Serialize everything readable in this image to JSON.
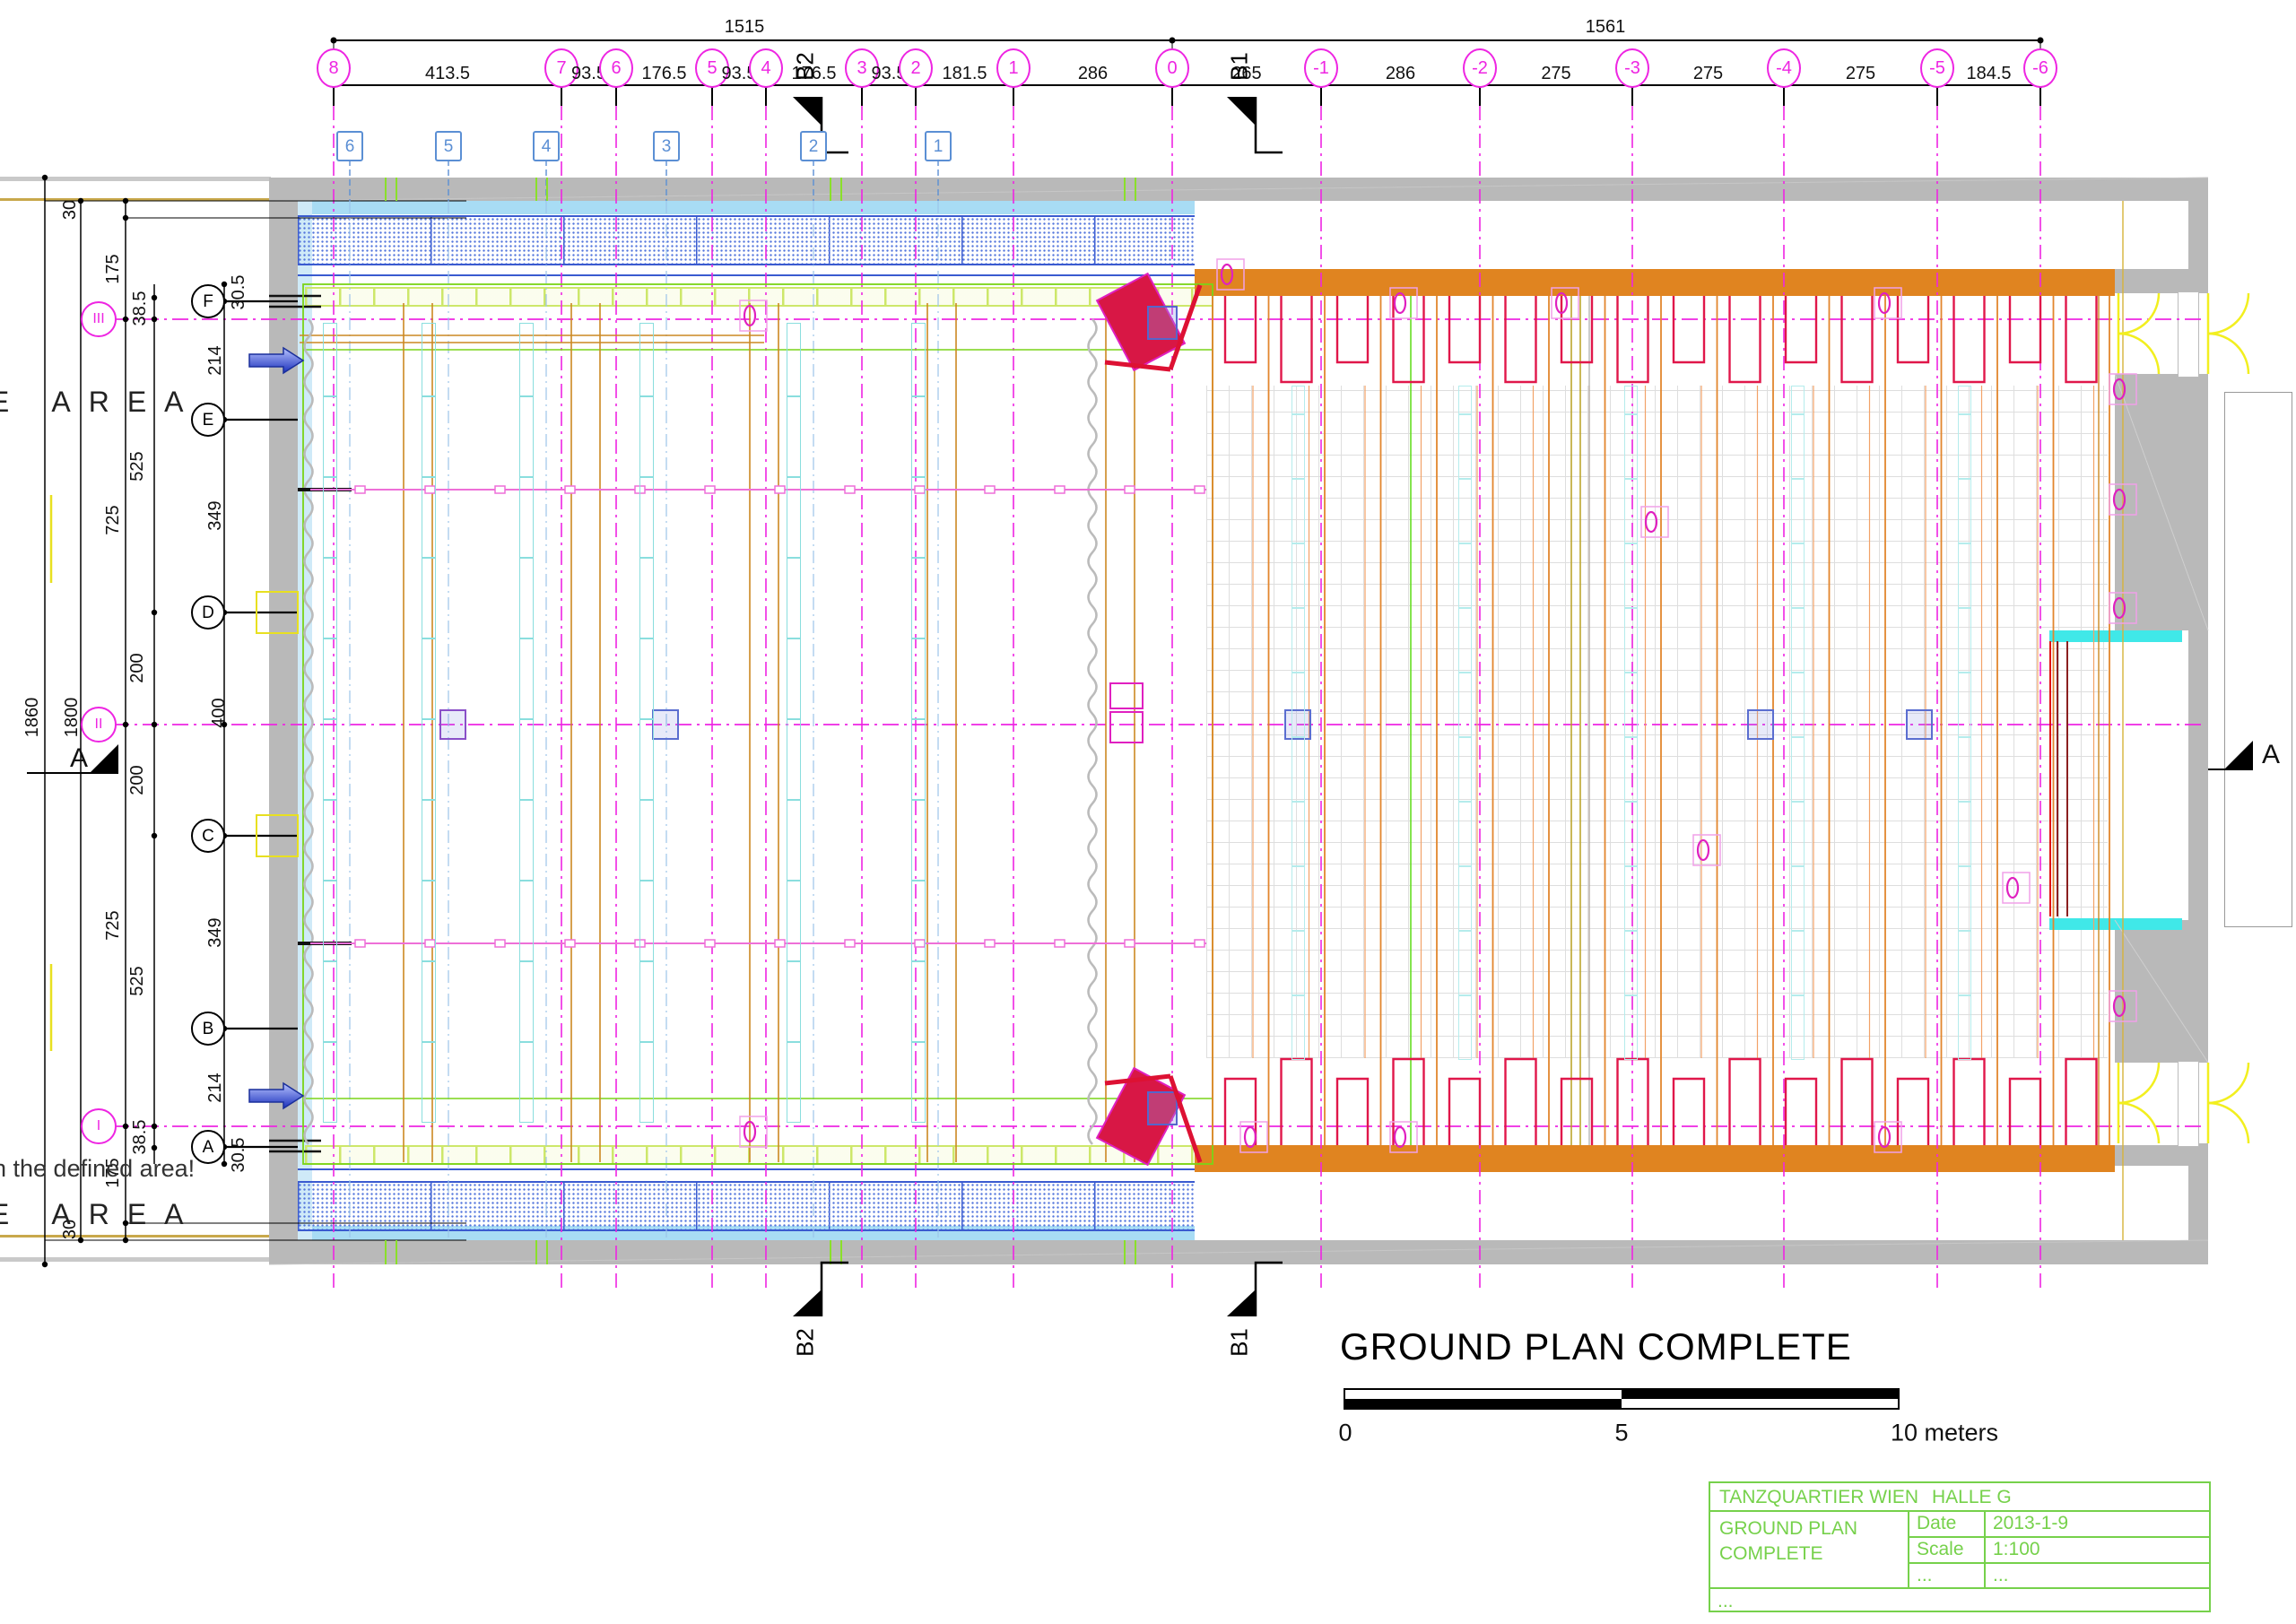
{
  "drawing": {
    "title": "GROUND PLAN COMPLETE"
  },
  "scale_bar": {
    "tick_0": "0",
    "tick_5": "5",
    "tick_10": "10 meters"
  },
  "title_block": {
    "project": "TANZQUARTIER WIEN",
    "hall": "HALLE G",
    "drawing_title_line1": "GROUND PLAN",
    "drawing_title_line2": "COMPLETE",
    "date_label": "Date",
    "date_value": "2013-1-9",
    "scale_label": "Scale",
    "scale_value": "1:100",
    "misc_label": "...",
    "misc_value": "...",
    "footer": "..."
  },
  "top_dimensions": {
    "overall_left": "1515",
    "overall_right": "1561",
    "column_bubbles": [
      "8",
      "7",
      "6",
      "5",
      "4",
      "3",
      "2",
      "1",
      "0",
      "-1",
      "-2",
      "-3",
      "-4",
      "-5",
      "-6"
    ],
    "column_spacings": [
      "413.5",
      "93.5",
      "176.5",
      "93.5",
      "176.5",
      "93.5",
      "181.5",
      "286",
      "265",
      "286",
      "275",
      "275",
      "275",
      "184.5"
    ]
  },
  "left_dimensions": {
    "overall": "1860",
    "inner": "1800",
    "chain_outer": [
      "30",
      "175",
      "725",
      "725",
      "175",
      "30"
    ],
    "chain_mid": [
      "38.5",
      "525",
      "200",
      "200",
      "525",
      "38.5"
    ],
    "chain_row": [
      "30.5",
      "214",
      "349",
      "400",
      "349",
      "214",
      "30.5"
    ]
  },
  "grid": {
    "row_bubbles": [
      "F",
      "E",
      "D",
      "C",
      "B",
      "A"
    ],
    "axis_bubbles": [
      "III",
      "II",
      "I"
    ],
    "stage_bar_labels": [
      "6",
      "5",
      "4",
      "3",
      "2",
      "1"
    ]
  },
  "sections": {
    "b2": "B2",
    "b1": "B1",
    "a": "A"
  },
  "annotations": {
    "stage_area_left_top": "GE AREA",
    "stage_area_left_bottom": "GE AREA",
    "note": "n the defined area!"
  },
  "colors": {
    "grid_magenta": "#ee25e2",
    "wall_gray": "#b9b9b9",
    "band_orange": "#e08420",
    "stage_lime": "#7ad418",
    "seat_red": "#e0174a",
    "crimson": "#d81745",
    "cyan": "#40e8e8",
    "hatch_blue": "#3a5bd0",
    "titleblock_green": "#76d14b",
    "stage_bar_blue": "#5b8fd4",
    "tan": "#c8a84b"
  }
}
